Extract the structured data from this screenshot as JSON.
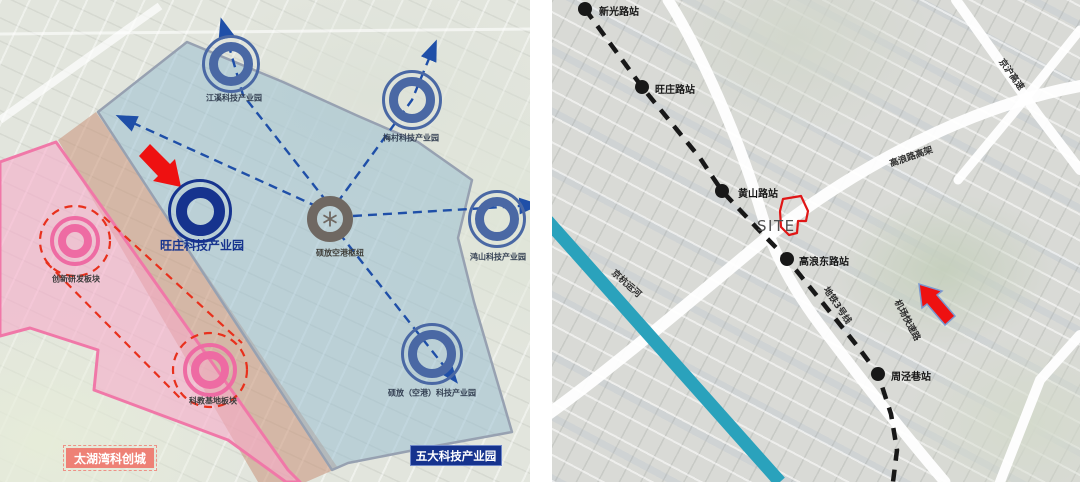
{
  "colors": {
    "accent-red": "#ee1111",
    "navy": "#16338e",
    "park-blue": "#4a68a4",
    "hub-gray": "#6f6862",
    "block-pink": "#ee6ba3",
    "zone-blue-border": "#97a1b1",
    "zone-pink-border": "#f078a8",
    "dash-blue": "#1f4fa8",
    "dash-red": "#e8301c",
    "canal-teal": "#2aa2bc",
    "metro-black": "#181818",
    "site-red": "#e01616",
    "badge-pink": "#ee8176",
    "road-white": "#ffffff"
  },
  "left": {
    "parks": [
      {
        "label": "江溪科技产业园"
      },
      {
        "label": "梅村科技产业园"
      },
      {
        "label": "鸿山科技产业园"
      },
      {
        "label": "硕放（空港）科技产业园"
      },
      {
        "label": "旺庄科技产业园"
      }
    ],
    "hub_label": "硕放空港枢纽",
    "blocks": [
      {
        "label": "创新研发板块"
      },
      {
        "label": "科教基地板块"
      }
    ],
    "badge_pink": "太湖湾科创城",
    "badge_blue": "五大科技产业园"
  },
  "right": {
    "stations": [
      {
        "label": "新光路站"
      },
      {
        "label": "旺庄路站"
      },
      {
        "label": "黄山路站"
      },
      {
        "label": "高浪东路站"
      },
      {
        "label": "周泾巷站"
      }
    ],
    "metro_line_label": "地铁3号线",
    "site_label": "SITE",
    "canal_label": "京杭运河",
    "roads": [
      {
        "label": "京沪高速"
      },
      {
        "label": "高浪路高架"
      },
      {
        "label": "机场快速路"
      }
    ]
  }
}
